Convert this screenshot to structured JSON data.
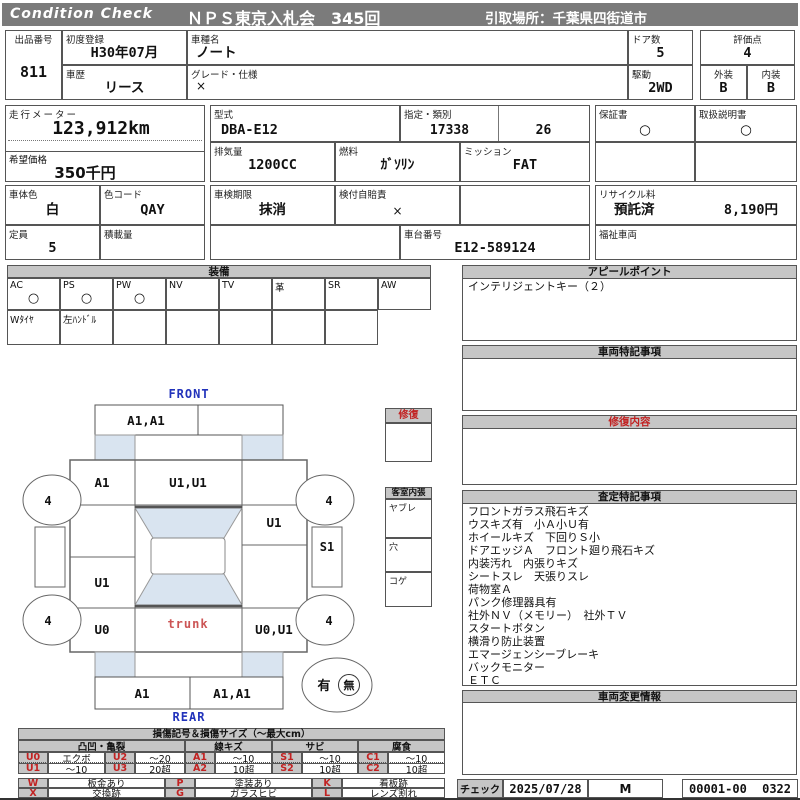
{
  "header": {
    "brand": "Condition Check",
    "auction": "ＮＰＳ東京入札会　345回",
    "pickup": "引取場所：千葉県四街道市"
  },
  "info": {
    "lot_label": "出品番号",
    "lot": "811",
    "first_reg_label": "初度登録",
    "first_reg": "H30年07月",
    "history_label": "車歴",
    "history": "リース",
    "model_label": "車種名",
    "model": "ノート",
    "grade_spec_label": "グレード・仕様",
    "grade_spec": "×",
    "doors_label": "ドア数",
    "doors": "5",
    "drive_label": "駆動",
    "drive": "2WD",
    "score_label": "評価点",
    "score": "4",
    "exterior_label": "外装",
    "exterior": "B",
    "interior_label": "内装",
    "interior": "B",
    "odometer_label": "走行メーター",
    "odometer": "123,912km",
    "price_label": "希望価格",
    "price": "350千円",
    "model_code_label": "型式",
    "model_code": "DBA-E12",
    "type_label": "指定・類別",
    "type1": "17338",
    "type2": "26",
    "displacement_label": "排気量",
    "displacement": "1200CC",
    "fuel_label": "燃料",
    "fuel": "ｶﾞｿﾘﾝ",
    "mission_label": "ミッション",
    "mission": "FAT",
    "warranty_label": "保証書",
    "warranty": "○",
    "manual_label": "取扱説明書",
    "manual": "○",
    "color_label": "車体色",
    "color": "白",
    "color_code_label": "色コード",
    "color_code": "QAY",
    "inspection_label": "車検期限",
    "inspection": "抹消",
    "insurance_label": "検付自賠責",
    "insurance": "×",
    "recycle_label": "リサイクル料",
    "recycle_status": "預託済",
    "recycle_fee": "8,190円",
    "capacity_label": "定員",
    "capacity": "5",
    "load_label": "積載量",
    "load": "",
    "chassis_label": "車台番号",
    "chassis": "E12-589124",
    "welfare_label": "福祉車両",
    "welfare": ""
  },
  "equipment": {
    "title": "装備",
    "items": [
      {
        "label": "AC",
        "value": "○"
      },
      {
        "label": "PS",
        "value": "○"
      },
      {
        "label": "PW",
        "value": "○"
      },
      {
        "label": "NV",
        "value": ""
      },
      {
        "label": "TV",
        "value": ""
      },
      {
        "label": "革",
        "value": ""
      },
      {
        "label": "SR",
        "value": ""
      },
      {
        "label": "AW",
        "value": ""
      }
    ],
    "extra_row": [
      "Wﾀｲﾔ",
      "左ﾊﾝﾄﾞﾙ",
      "",
      "",
      "",
      "",
      ""
    ]
  },
  "sections": {
    "appeal": {
      "title": "アピールポイント",
      "line1": "インテリジェントキー（２）"
    },
    "notes": {
      "title": "車両特記事項"
    },
    "repair": {
      "title": "修復内容"
    },
    "assessment": {
      "title": "査定特記事項",
      "lines": [
        "フロントガラス飛石キズ",
        "ウスキズ有　小Ａ小Ｕ有",
        "ホイールキズ　下回りＳ小",
        "ドアエッジＡ　フロント廻り飛石キズ",
        "内装汚れ　内張りキズ",
        "シートスレ　天張りスレ",
        "荷物室Ａ",
        "パンク修理器具有",
        "社外ＮＶ（メモリー）　社外ＴＶ",
        "スタートボタン",
        "横滑り防止装置",
        "エマージェンシーブレーキ",
        "バックモニター",
        "ＥＴＣ"
      ]
    },
    "changes": {
      "title": "車両変更情報"
    }
  },
  "diagram": {
    "front_label": "FRONT",
    "rear_label": "REAR",
    "front_bumper_left": "A1,A1",
    "front_bumper_right": "",
    "left_fender": "A1",
    "hood_roof": "U1,U1",
    "right_front_door": "U1",
    "left_rear_door": "U1",
    "left_quarter": "U0",
    "right_quarter": "U0,U1",
    "trunk": "trunk",
    "right_sill": "S1",
    "left_sill": "",
    "wheels": [
      "4",
      "4",
      "4",
      "4"
    ],
    "rear_bumper_left": "A1",
    "rear_bumper_right": "A1,A1",
    "record_yes": "有",
    "record_no": "無",
    "repair_box_title": "修復",
    "cabin_box_title": "客室内張",
    "cabin_rows": [
      "ヤブレ",
      "穴",
      "コゲ"
    ]
  },
  "legend": {
    "title": "損傷記号＆損傷サイズ（～最大cm）",
    "groups": [
      "凸凹・亀裂",
      "線キズ",
      "サビ",
      "腐食"
    ],
    "row1": [
      "U0",
      "エクボ",
      "U2",
      "～20",
      "A1",
      "～10",
      "S1",
      "～10",
      "C1",
      "～10"
    ],
    "row2": [
      "U1",
      "～10",
      "U3",
      "20超",
      "A2",
      "10超",
      "S2",
      "10超",
      "C2",
      "10超"
    ],
    "row3": [
      "W",
      "板金あり",
      "P",
      "塗装あり",
      "K",
      "看板跡"
    ],
    "row4": [
      "X",
      "交換跡",
      "G",
      "ガラスヒビ",
      "L",
      "レンズ割れ"
    ]
  },
  "footer": {
    "check_label": "チェック",
    "date": "2025/07/28",
    "inspector": "M",
    "code_left": "00001-00",
    "code_right": "0322"
  },
  "colors": {
    "bar_gray": "#7b7b7b",
    "cell_gray": "#c6c6c6",
    "glass_blue": "#d9e4f0",
    "accent_red": "#c22222",
    "label_blue": "#2233bb"
  }
}
